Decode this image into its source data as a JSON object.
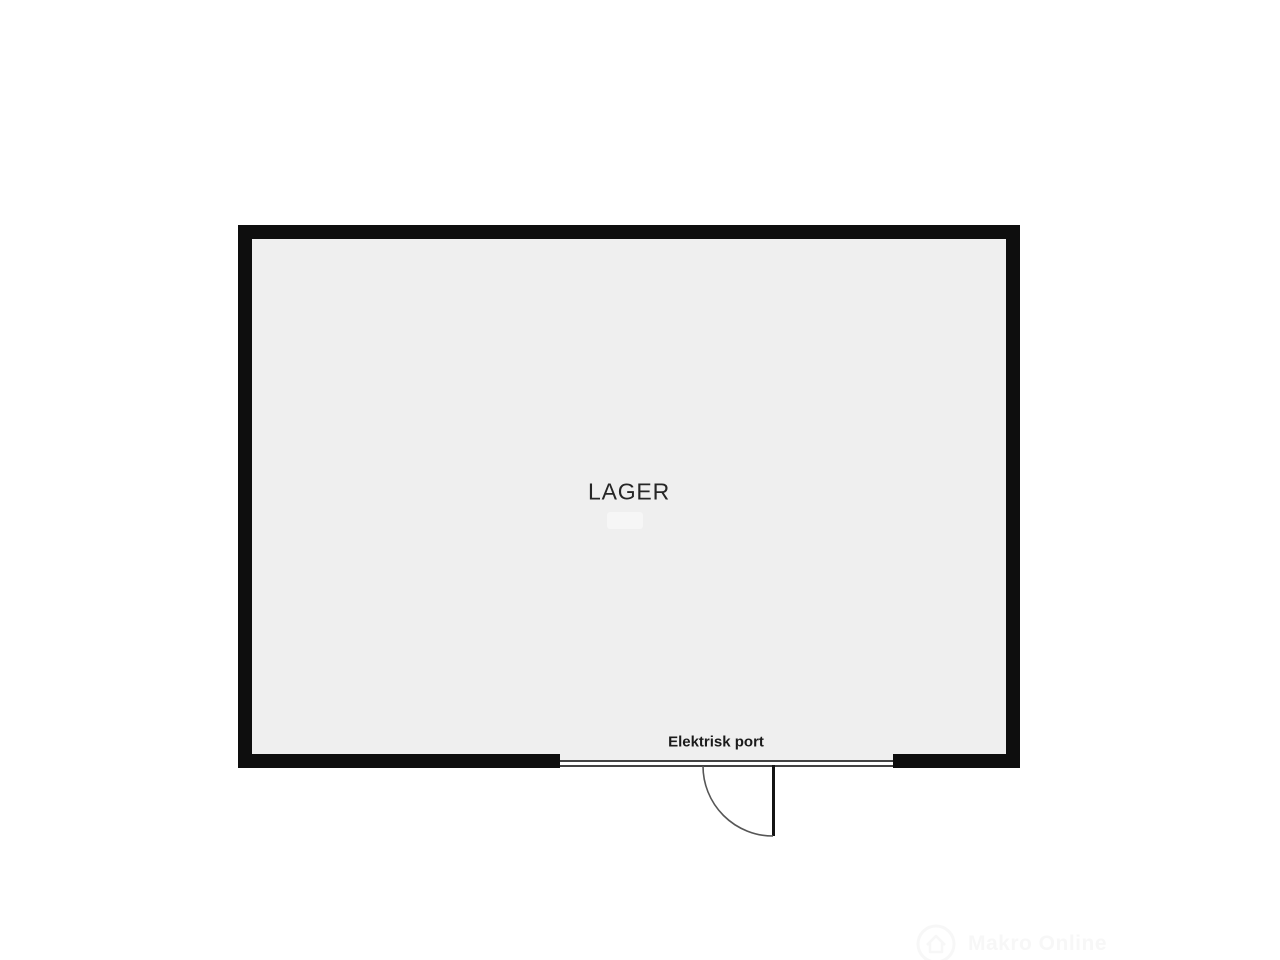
{
  "floor_plan": {
    "room": {
      "label": "LAGER"
    },
    "door": {
      "label": "Elektrisk port"
    },
    "watermark": {
      "text": "Makro Online"
    },
    "colors": {
      "wall": "#0e0e0e",
      "floor": "#efefef",
      "background": "#ffffff",
      "port_line": "#424242",
      "label_text": "#262626"
    }
  }
}
